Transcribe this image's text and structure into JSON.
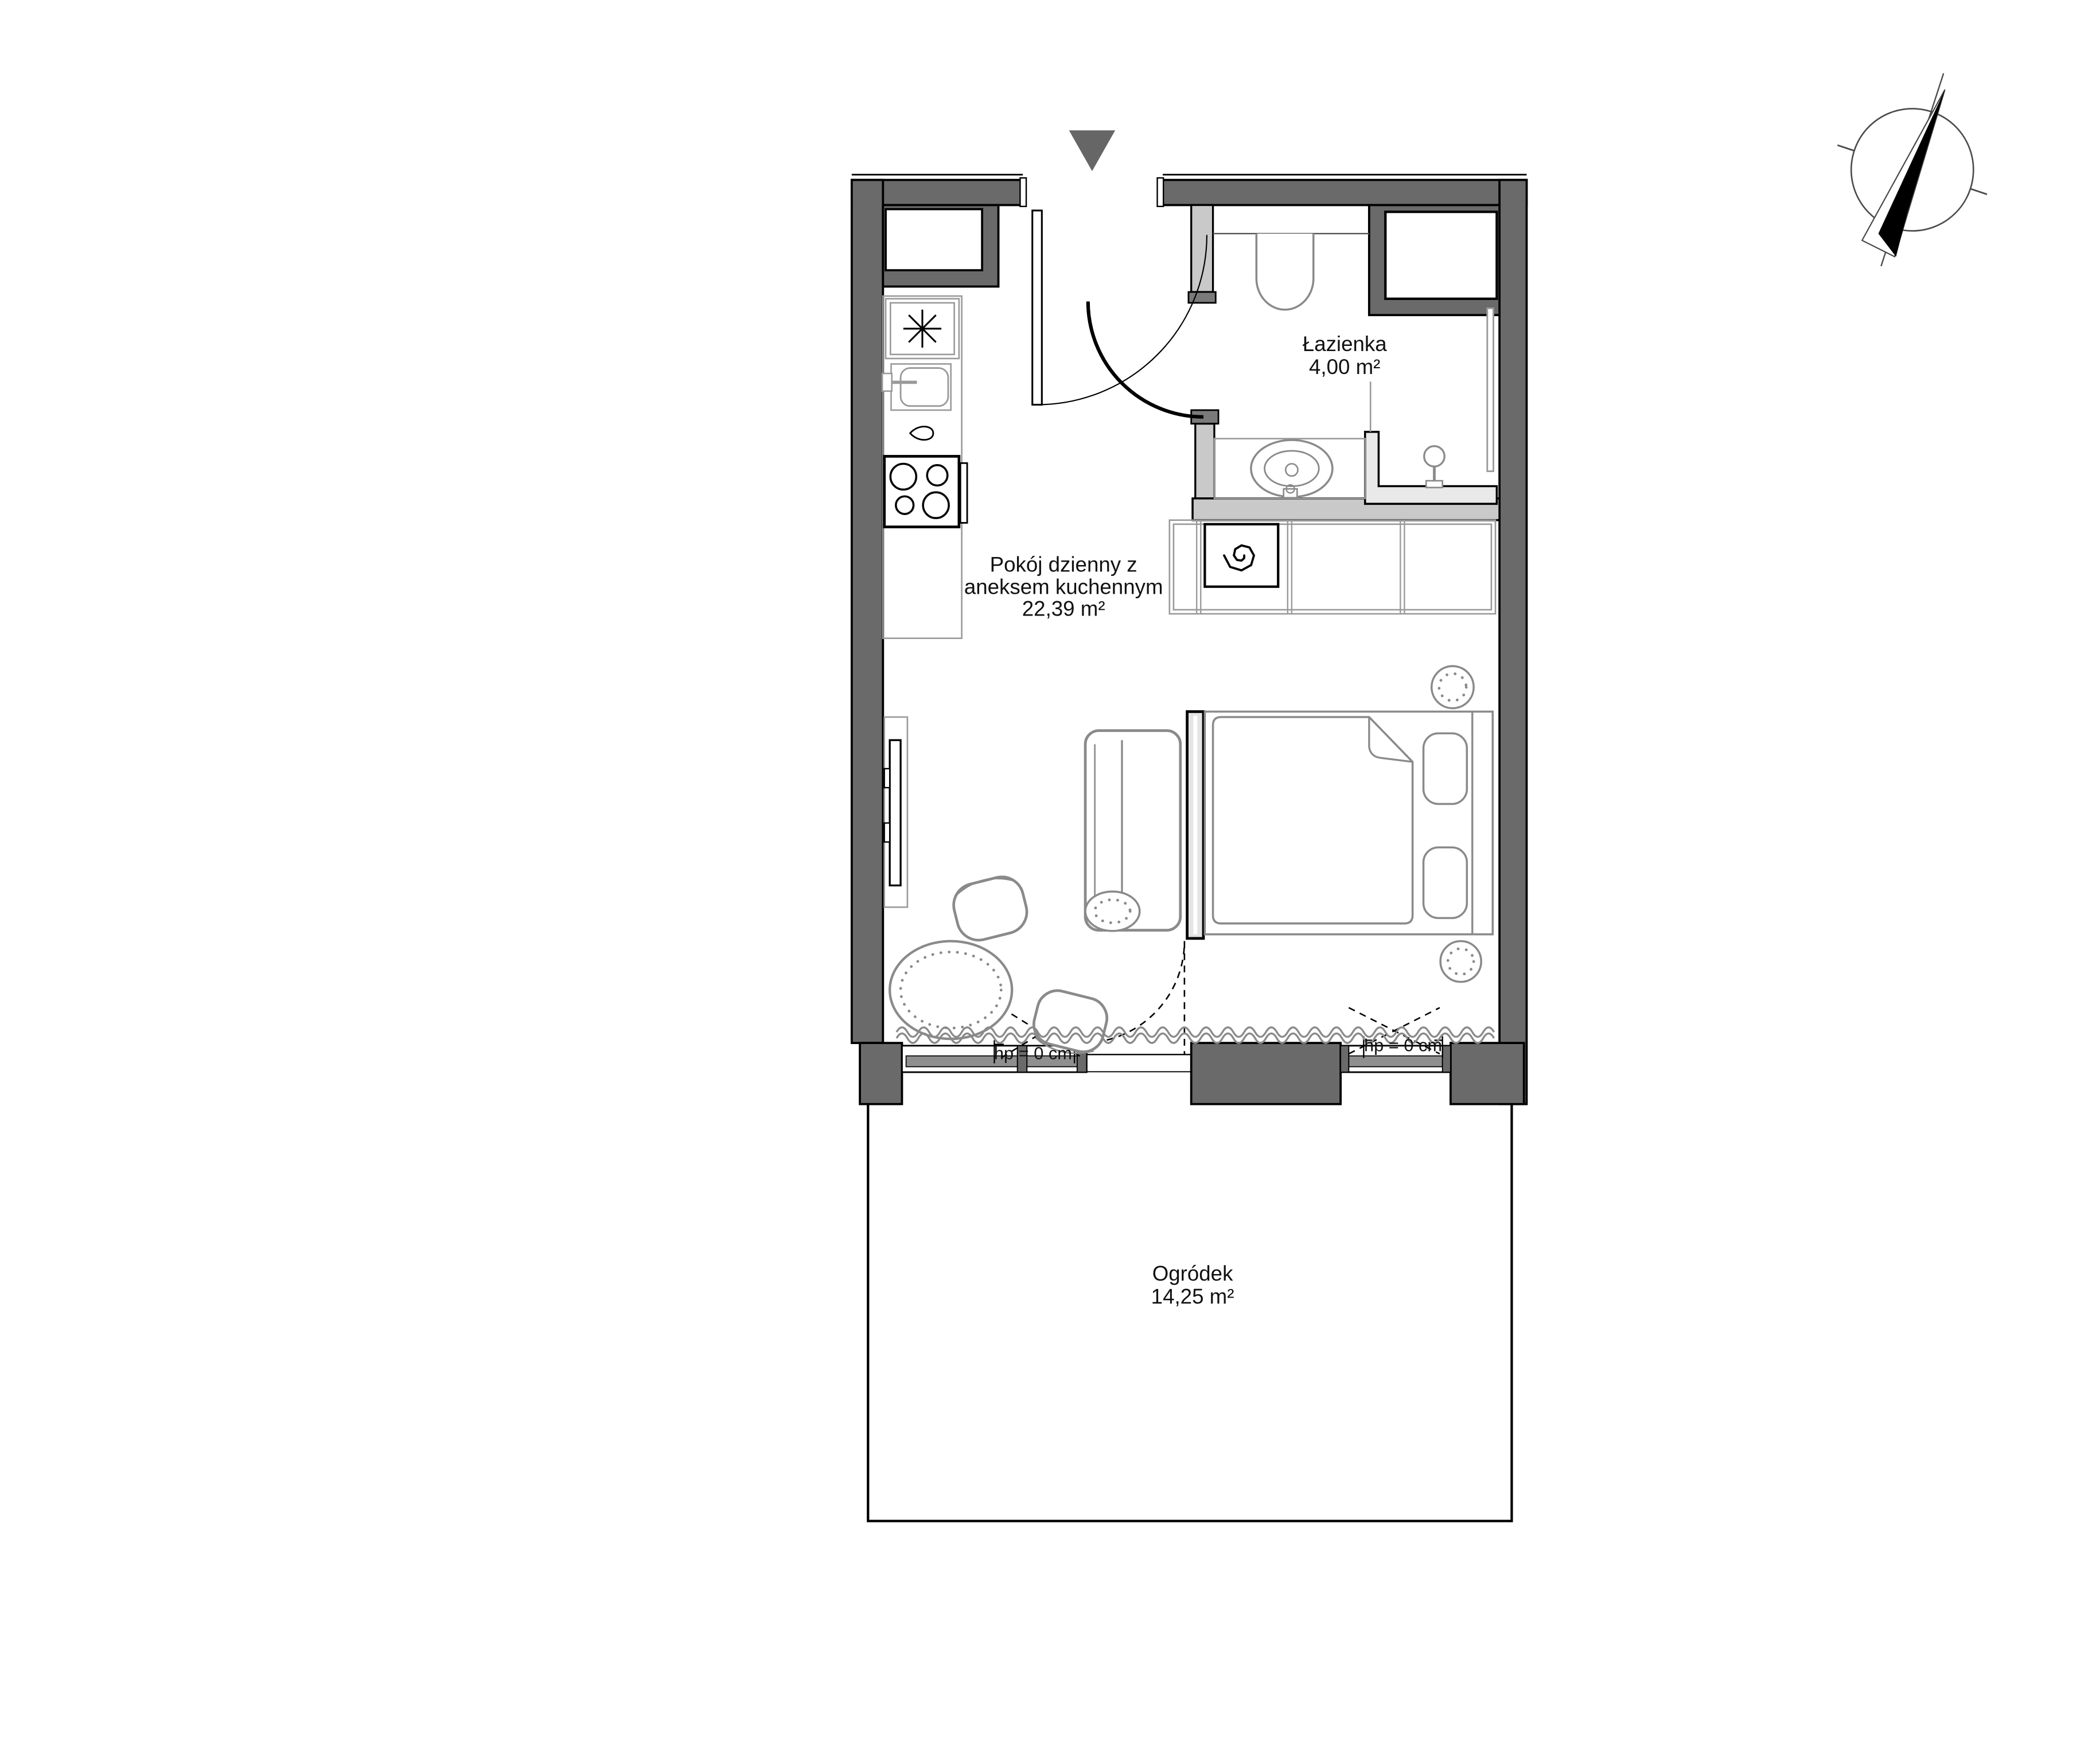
{
  "rooms": [
    {
      "id": "bathroom",
      "name": "Łazienka",
      "area": "4,00 m²"
    },
    {
      "id": "living",
      "name_line1": "Pokój dzienny z",
      "name_line2": "aneksem kuchennym",
      "area": "22,39 m²"
    },
    {
      "id": "garden",
      "name": "Ogródek",
      "area": "14,25 m²"
    }
  ],
  "windows": [
    {
      "id": "window-left-door",
      "label": "hp = 0 cm"
    },
    {
      "id": "window-right",
      "label": "hp = 0 cm"
    }
  ],
  "icons": {
    "compass": "compass-north-icon",
    "entry": "entry-arrow-icon",
    "fridge": "fridge-icon",
    "sink": "kitchen-sink-icon",
    "stove": "stove-icon",
    "washer": "washing-machine-icon",
    "toilet": "toilet-icon",
    "basin": "bathroom-basin-icon",
    "shower": "shower-icon"
  },
  "colors": {
    "wall": "#6a6a6a",
    "wall_light": "#c9c9c9",
    "wall_cap": "#7a7a7a",
    "floor_light": "#e9e9e9",
    "sill": "#8f8f8f",
    "furniture_line": "#8a8a8a",
    "marker": "#666666",
    "text": "#111111"
  }
}
